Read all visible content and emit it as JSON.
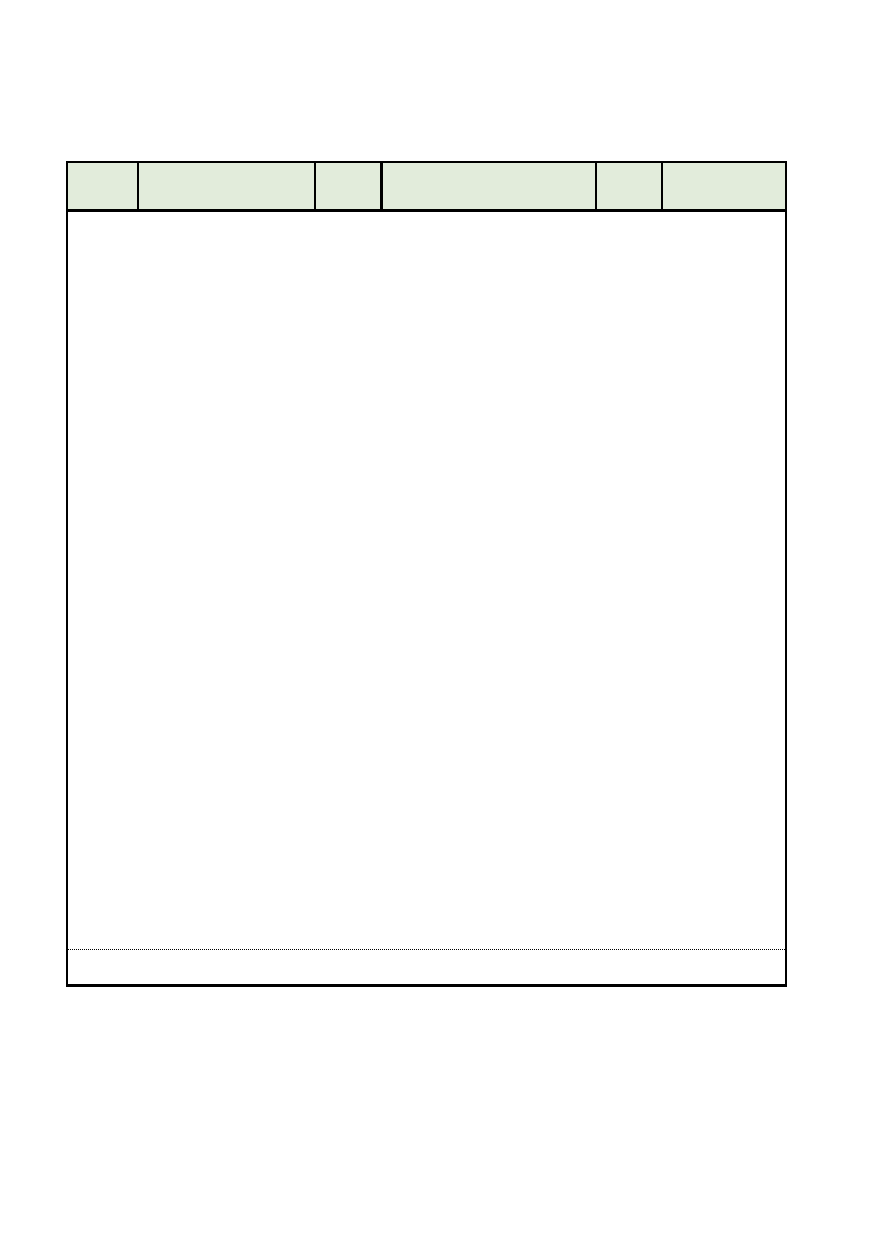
{
  "page": {
    "background_color": "#ffffff"
  },
  "table": {
    "border_color": "#000000",
    "header": {
      "background_color": "#e2ecdb",
      "cells": [
        {
          "label": ""
        },
        {
          "label": ""
        },
        {
          "label": ""
        },
        {
          "label": ""
        },
        {
          "label": ""
        },
        {
          "label": ""
        }
      ]
    },
    "body": {
      "content": "",
      "footer_note": ""
    }
  }
}
